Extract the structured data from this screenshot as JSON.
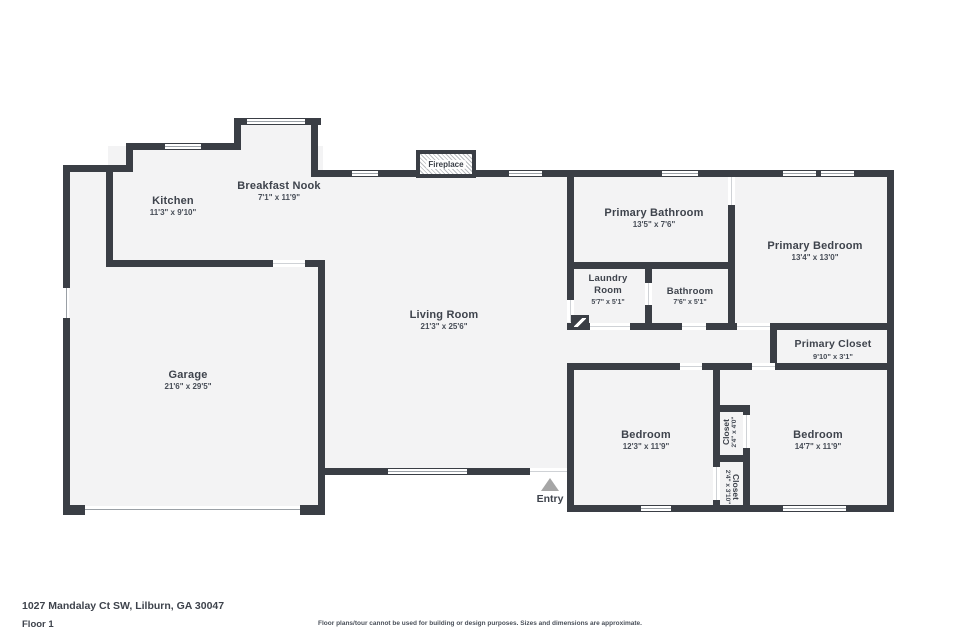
{
  "floorplan": {
    "fireplace": "Fireplace",
    "entry": "Entry",
    "rooms": {
      "kitchen": {
        "name": "Kitchen",
        "dims": "11'3\" x 9'10\""
      },
      "breakfast_nook": {
        "name": "Breakfast Nook",
        "dims": "7'1\" x 11'9\""
      },
      "living_room": {
        "name": "Living Room",
        "dims": "21'3\" x 25'6\""
      },
      "garage": {
        "name": "Garage",
        "dims": "21'6\" x 29'5\""
      },
      "primary_bathroom": {
        "name": "Primary Bathroom",
        "dims": "13'5\" x 7'6\""
      },
      "primary_bedroom": {
        "name": "Primary Bedroom",
        "dims": "13'4\" x 13'0\""
      },
      "laundry_room": {
        "name": "Laundry Room",
        "dims": "5'7\" x 5'1\""
      },
      "bathroom": {
        "name": "Bathroom",
        "dims": "7'6\" x 5'1\""
      },
      "primary_closet": {
        "name": "Primary Closet",
        "dims": "9'10\" x 3'1\""
      },
      "bedroom_left": {
        "name": "Bedroom",
        "dims": "12'3\" x 11'9\""
      },
      "bedroom_right": {
        "name": "Bedroom",
        "dims": "14'7\" x 11'9\""
      },
      "closet_top": {
        "name": "Closet",
        "dims": "2'4\" x 4'0\""
      },
      "closet_bottom": {
        "name": "Closet",
        "dims": "2'4\" x 3'10\""
      }
    },
    "watermark": {
      "line1": "Real Tour South Metro",
      "line2": "Photography"
    },
    "footer": {
      "address": "1027 Mandalay Ct SW, Lilburn, GA 30047",
      "floor_label": "Floor 1",
      "disclaimer": "Floor plans/tour cannot be used for building or design purposes. Sizes and dimensions are approximate."
    },
    "colors": {
      "wall": "#3a3e45",
      "floor": "#f3f3f4",
      "text": "#3e434c"
    }
  }
}
